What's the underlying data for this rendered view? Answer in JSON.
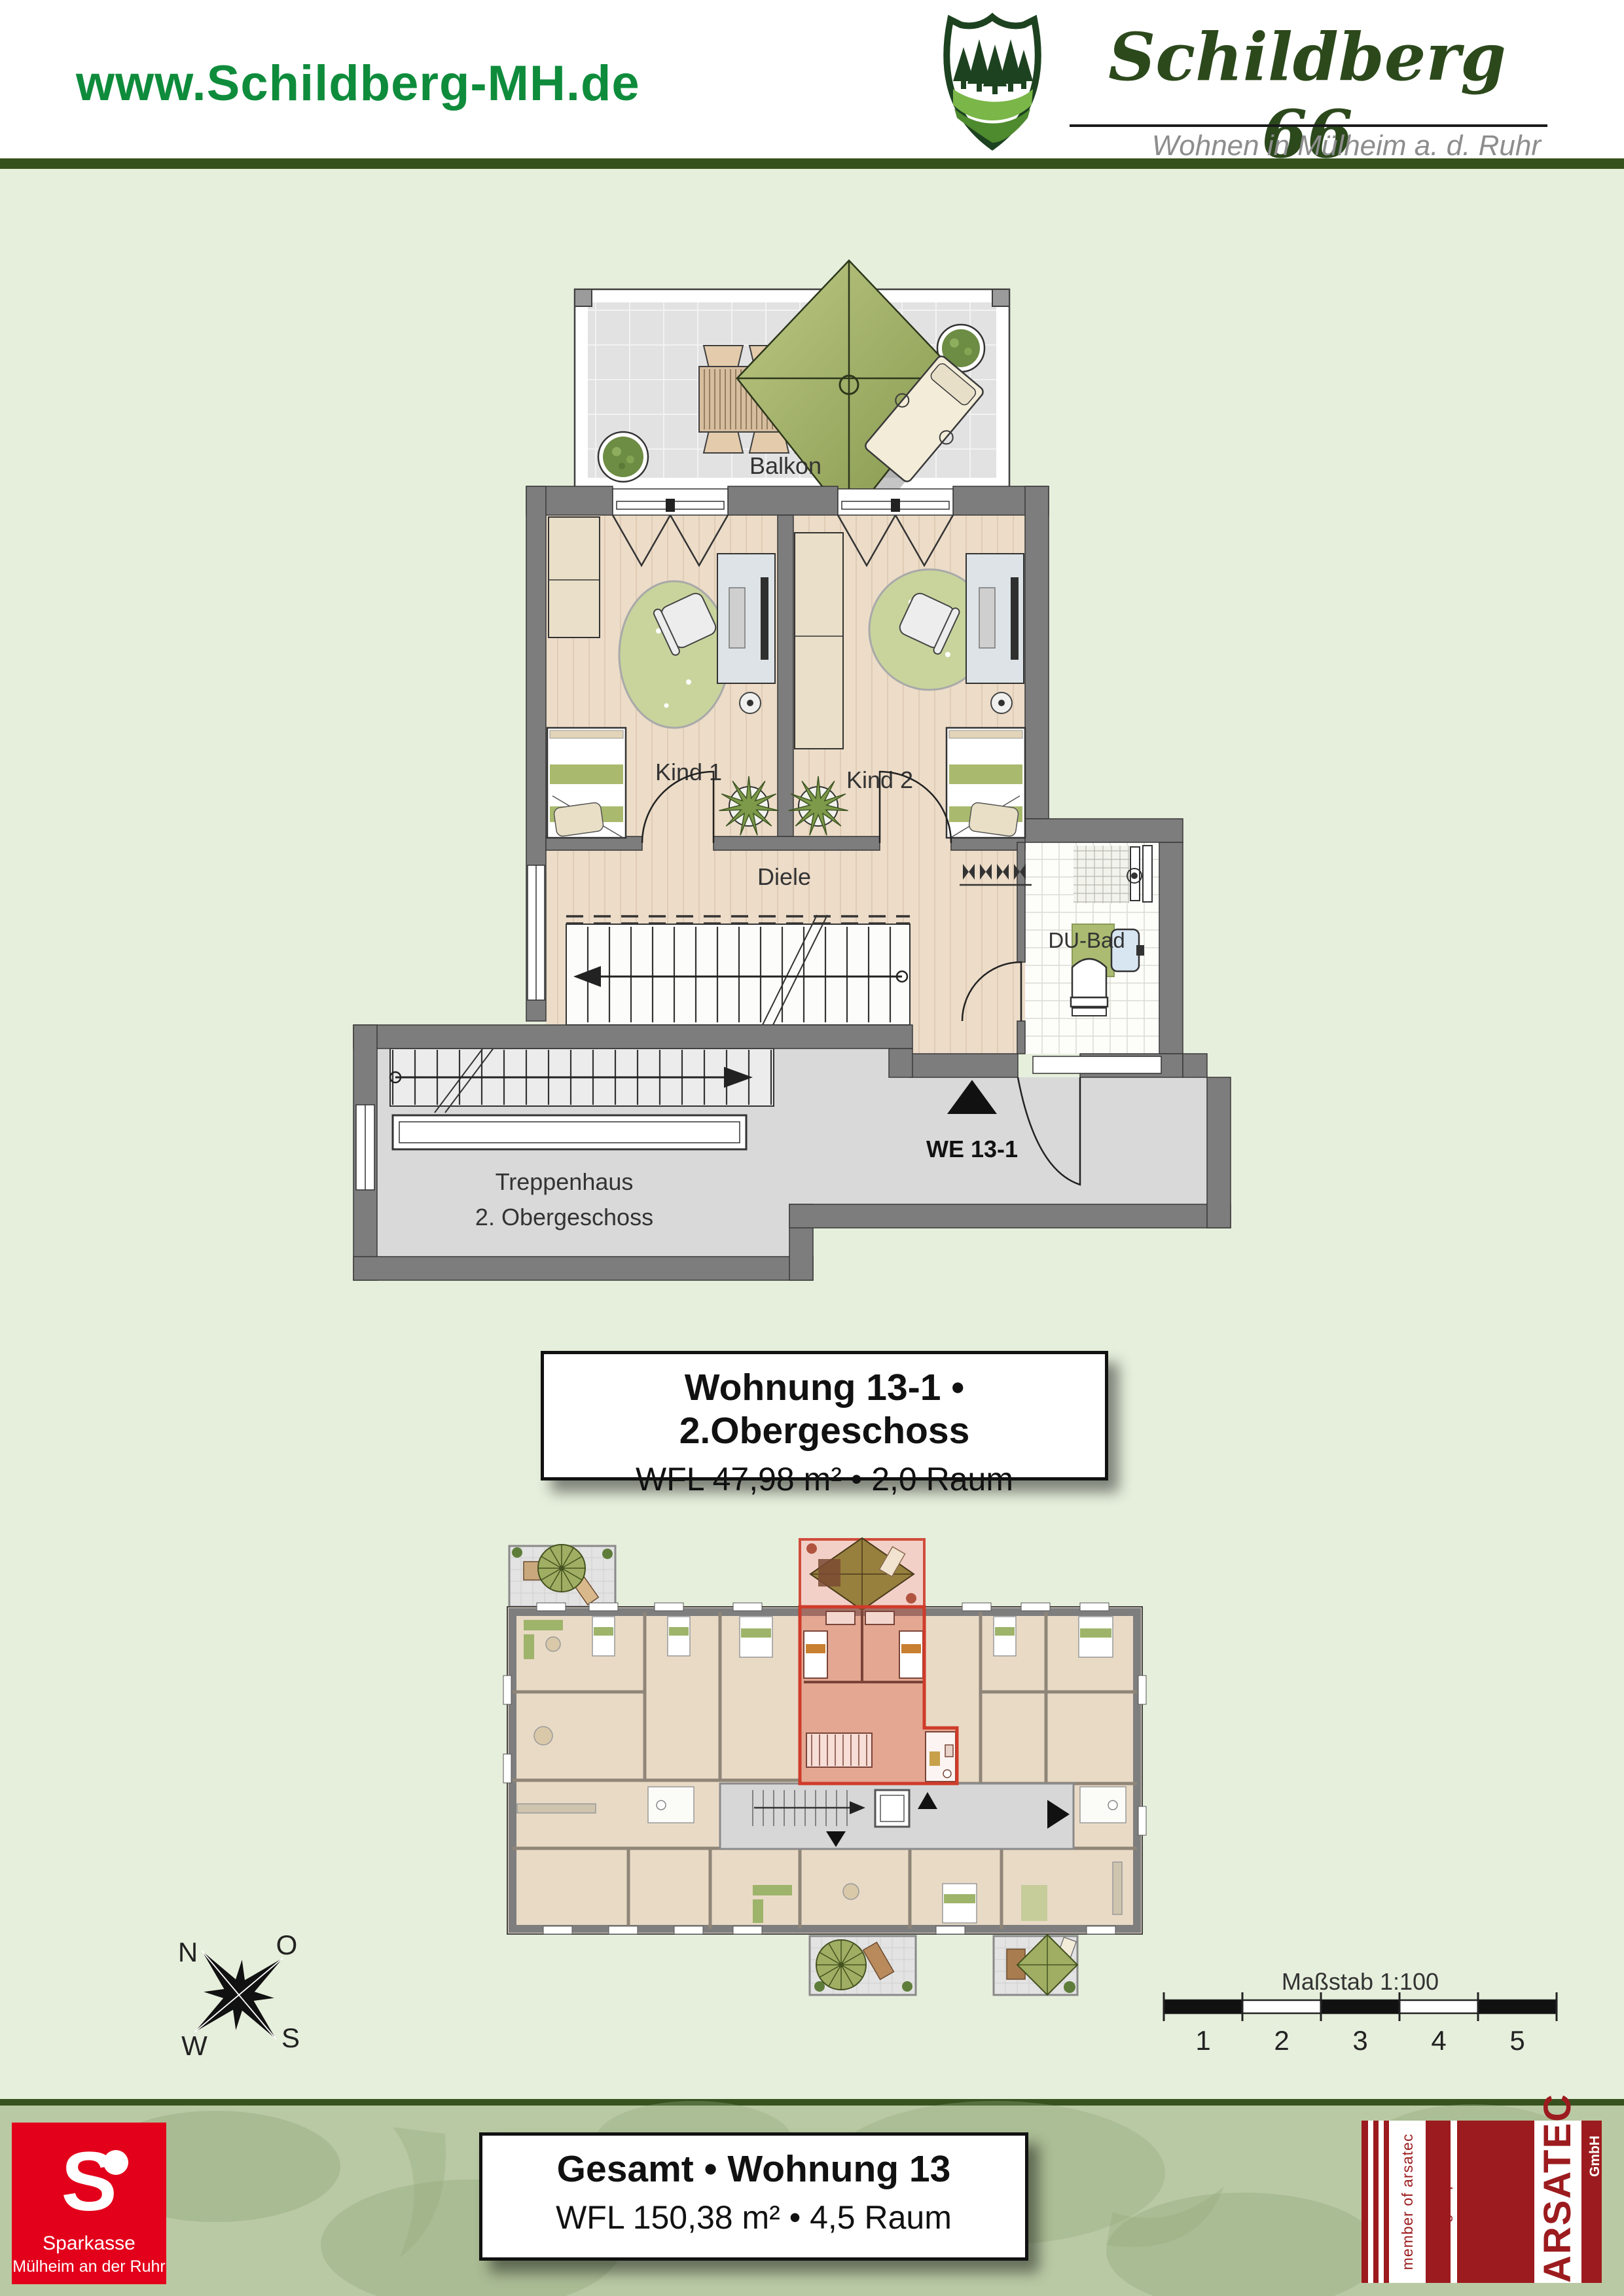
{
  "header": {
    "website": "www.Schildberg-MH.de",
    "brand": {
      "name": "Schildberg 66",
      "tagline": "Wohnen in Mülheim a. d. Ruhr"
    }
  },
  "floorplan": {
    "balcony_label": "Balkon",
    "room1_label": "Kind 1",
    "room2_label": "Kind 2",
    "hall_label": "Diele",
    "bath_label": "DU-Bad",
    "unit_label": "WE 13-1",
    "stairwell_label_line1": "Treppenhaus",
    "stairwell_label_line2": "2. Obergeschoss"
  },
  "info_box": {
    "title": "Wohnung 13-1 • 2.Obergeschoss",
    "subtitle": "WFL 47,98 m² • 2,0 Raum"
  },
  "overview": {
    "compass": {
      "n": "N",
      "o": "O",
      "s": "S",
      "w": "W"
    },
    "scale": {
      "title": "Maßstab 1:100",
      "ticks": [
        "1",
        "2",
        "3",
        "4",
        "5"
      ]
    }
  },
  "footer": {
    "sparkasse": {
      "symbol": "S",
      "line1": "Sparkasse",
      "line2": "Mülheim an der Ruhr"
    },
    "total_box": {
      "title": "Gesamt • Wohnung 13",
      "subtitle": "WFL 150,38 m² • 4,5 Raum"
    },
    "arsatec": {
      "member": "member of arsatec group",
      "name": "ARSATEC",
      "gmbh": "GmbH"
    }
  },
  "colors": {
    "page_bg": "#e6efdc",
    "header_green": "#0e8c3c",
    "brand_green": "#2c491c",
    "divider_green": "#35521c",
    "footer_band": "#b9c9a4",
    "wall_gray": "#7d7d7d",
    "wood_floor": "#ecdcc8",
    "highlight_red": "#cf3b2a",
    "sparkasse_red": "#e3001b",
    "arsatec_red": "#9c1b1e",
    "accent_olive": "#a9ba6e"
  }
}
